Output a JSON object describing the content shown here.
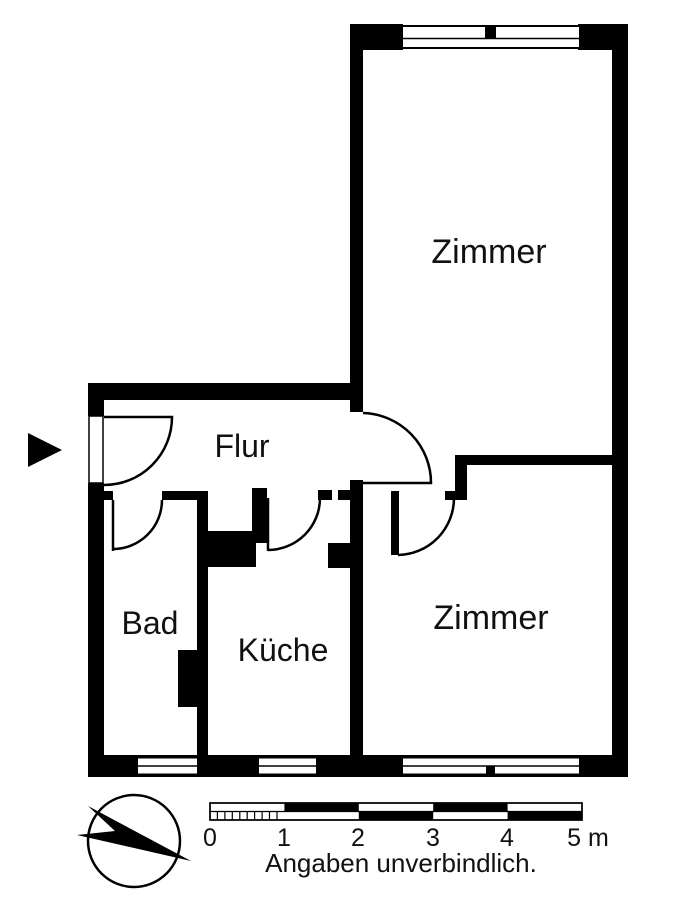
{
  "rooms": [
    {
      "id": "zimmer-top",
      "label": "Zimmer"
    },
    {
      "id": "zimmer-bottom",
      "label": "Zimmer"
    },
    {
      "id": "flur",
      "label": "Flur"
    },
    {
      "id": "bad",
      "label": "Bad"
    },
    {
      "id": "kueche",
      "label": "Küche"
    }
  ],
  "scale_bar": {
    "unit_labels": [
      "0",
      "1",
      "2",
      "3",
      "4",
      "5 m"
    ],
    "caption": "Angaben unverbindlich."
  },
  "colors": {
    "wall": "#000000",
    "background": "#ffffff",
    "text": "#111111"
  }
}
